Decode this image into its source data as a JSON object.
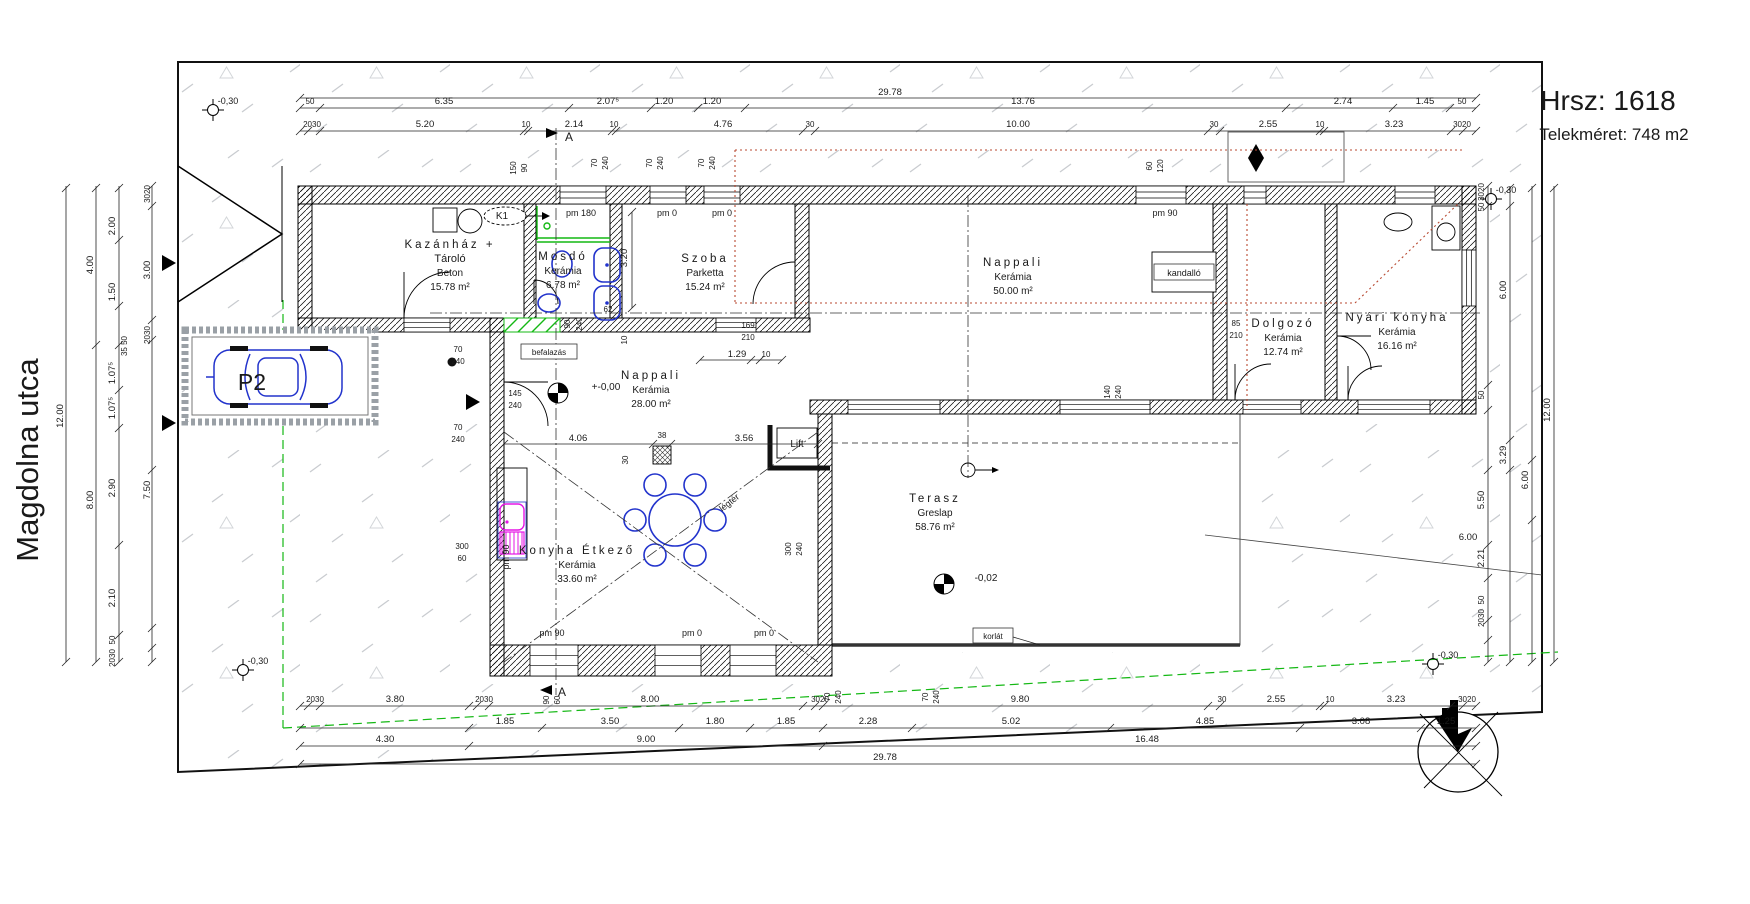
{
  "title": {
    "parcel": "Hrsz: 1618",
    "site_area": "Telekméret: 748 m2"
  },
  "street": {
    "name": "Magdolna utca"
  },
  "parking": {
    "label": "P2"
  },
  "rooms": [
    {
      "id": "kazanhaz",
      "name": "Kazánház +",
      "name2": "Tároló",
      "floor": "Beton",
      "area": "15.78 m²",
      "x": 450,
      "y": 248
    },
    {
      "id": "mosdo",
      "name": "Mosdó",
      "floor": "Kerámia",
      "area": "6.78 m²",
      "x": 563,
      "y": 260
    },
    {
      "id": "szoba",
      "name": "Szoba",
      "floor": "Parketta",
      "area": "15.24 m²",
      "x": 705,
      "y": 262
    },
    {
      "id": "nappali-nagy",
      "name": "Nappali",
      "floor": "Kerámia",
      "area": "50.00 m²",
      "x": 1013,
      "y": 266
    },
    {
      "id": "dolgozo",
      "name": "Dolgozó",
      "floor": "Kerámia",
      "area": "12.74 m²",
      "x": 1283,
      "y": 327
    },
    {
      "id": "nyari-konyha",
      "name": "Nyári konyha",
      "floor": "Kerámia",
      "area": "16.16 m²",
      "x": 1397,
      "y": 321
    },
    {
      "id": "nappali-kozep",
      "name": "Nappali",
      "floor": "Kerámia",
      "area": "28.00 m²",
      "x": 651,
      "y": 379
    },
    {
      "id": "konyha-etkezo",
      "name": "Konyha Étkező",
      "floor": "Kerámia",
      "area": "33.60 m²",
      "x": 577,
      "y": 554
    },
    {
      "id": "terasz",
      "name": "Terasz",
      "floor": "Greslap",
      "area": "58.76 m²",
      "x": 935,
      "y": 502
    }
  ],
  "annotations": [
    {
      "id": "k1",
      "t": "K1",
      "x": 502,
      "y": 219,
      "s": 10
    },
    {
      "id": "kandallo",
      "t": "kandalló",
      "x": 1184,
      "y": 276,
      "box": true,
      "w": 60,
      "s": 9
    },
    {
      "id": "befalazas",
      "t": "befalazás",
      "x": 549,
      "y": 355,
      "box": true,
      "w": 56,
      "s": 8
    },
    {
      "id": "lift",
      "t": "Lift",
      "x": 797,
      "y": 447,
      "s": 10
    },
    {
      "id": "legter",
      "t": "légtér",
      "x": 731,
      "y": 505,
      "r": -38,
      "s": 9
    },
    {
      "id": "korlat",
      "t": "korlát",
      "x": 993,
      "y": 639,
      "box": true,
      "w": 40,
      "s": 8
    }
  ],
  "levels": [
    {
      "t": "+-0,00",
      "x": 606,
      "y": 390,
      "sx": 558,
      "sy": 393
    },
    {
      "t": "-0,02",
      "x": 986,
      "y": 581,
      "sx": 944,
      "sy": 584
    }
  ],
  "survey_points": [
    {
      "t": "-0,30",
      "x": 228,
      "y": 104,
      "sx": 213,
      "sy": 110
    },
    {
      "t": "-0,30",
      "x": 1506,
      "y": 193,
      "sx": 1491,
      "sy": 199
    },
    {
      "t": "-0,30",
      "x": 258,
      "y": 664,
      "sx": 243,
      "sy": 670
    },
    {
      "t": "-0,30",
      "x": 1448,
      "y": 658,
      "sx": 1433,
      "sy": 664
    }
  ],
  "sections": [
    {
      "t": "A",
      "x": 569,
      "y": 141,
      "ax": 546,
      "ay": 133,
      "dir": 1
    },
    {
      "t": "A",
      "x": 562,
      "y": 696,
      "ax": 540,
      "ay": 690,
      "dir": -1
    }
  ],
  "pm_labels": [
    {
      "t": "pm 180",
      "x": 581,
      "y": 216
    },
    {
      "t": "pm 0",
      "x": 667,
      "y": 216
    },
    {
      "t": "pm 0",
      "x": 722,
      "y": 216
    },
    {
      "t": "pm 90",
      "x": 1165,
      "y": 216
    },
    {
      "t": "pm 90",
      "x": 552,
      "y": 636
    },
    {
      "t": "pm 0",
      "x": 692,
      "y": 636
    },
    {
      "t": "pm 0",
      "x": 764,
      "y": 636
    },
    {
      "t": "pm 90",
      "x": 509,
      "y": 557,
      "r": -90
    }
  ],
  "dim_texts": [
    {
      "t": "29.78",
      "x": 890,
      "y": 95
    },
    {
      "t": "50",
      "x": 310,
      "y": 104,
      "s": 8
    },
    {
      "t": "6.35",
      "x": 444,
      "y": 104
    },
    {
      "t": "2.07⁵",
      "x": 608,
      "y": 104
    },
    {
      "t": "1.20",
      "x": 664,
      "y": 104
    },
    {
      "t": "1.20",
      "x": 712,
      "y": 104
    },
    {
      "t": "13.76",
      "x": 1023,
      "y": 104
    },
    {
      "t": "2.74",
      "x": 1343,
      "y": 104
    },
    {
      "t": "1.45",
      "x": 1425,
      "y": 104
    },
    {
      "t": "50",
      "x": 1462,
      "y": 104,
      "s": 8
    },
    {
      "t": "2030",
      "x": 312,
      "y": 127,
      "s": 8
    },
    {
      "t": "5.20",
      "x": 425,
      "y": 127
    },
    {
      "t": "10",
      "x": 526,
      "y": 127,
      "s": 8
    },
    {
      "t": "2.14",
      "x": 574,
      "y": 127
    },
    {
      "t": "10",
      "x": 614,
      "y": 127,
      "s": 8
    },
    {
      "t": "4.76",
      "x": 723,
      "y": 127
    },
    {
      "t": "30",
      "x": 810,
      "y": 127,
      "s": 8
    },
    {
      "t": "10.00",
      "x": 1018,
      "y": 127
    },
    {
      "t": "30",
      "x": 1214,
      "y": 127,
      "s": 8
    },
    {
      "t": "2.55",
      "x": 1268,
      "y": 127
    },
    {
      "t": "10",
      "x": 1320,
      "y": 127,
      "s": 8
    },
    {
      "t": "3.23",
      "x": 1394,
      "y": 127
    },
    {
      "t": "3020",
      "x": 1462,
      "y": 127,
      "s": 8
    },
    {
      "t": "2030",
      "x": 315,
      "y": 702,
      "s": 8
    },
    {
      "t": "3.80",
      "x": 395,
      "y": 702
    },
    {
      "t": "2030",
      "x": 484,
      "y": 702,
      "s": 8
    },
    {
      "t": "8.00",
      "x": 650,
      "y": 702
    },
    {
      "t": "3020",
      "x": 820,
      "y": 702,
      "s": 8
    },
    {
      "t": "9.80",
      "x": 1020,
      "y": 702
    },
    {
      "t": "30",
      "x": 1222,
      "y": 702,
      "s": 8
    },
    {
      "t": "2.55",
      "x": 1276,
      "y": 702
    },
    {
      "t": "10",
      "x": 1330,
      "y": 702,
      "s": 8
    },
    {
      "t": "3.23",
      "x": 1396,
      "y": 702
    },
    {
      "t": "3020",
      "x": 1467,
      "y": 702,
      "s": 8
    },
    {
      "t": "1.85",
      "x": 505,
      "y": 724
    },
    {
      "t": "3.50",
      "x": 610,
      "y": 724
    },
    {
      "t": "1.80",
      "x": 715,
      "y": 724
    },
    {
      "t": "1.85",
      "x": 786,
      "y": 724
    },
    {
      "t": "2.28",
      "x": 868,
      "y": 724
    },
    {
      "t": "5.02",
      "x": 1011,
      "y": 724
    },
    {
      "t": "4.85",
      "x": 1205,
      "y": 724
    },
    {
      "t": "3.08",
      "x": 1361,
      "y": 724
    },
    {
      "t": "1.25",
      "x": 1446,
      "y": 724
    },
    {
      "t": "4.30",
      "x": 385,
      "y": 742
    },
    {
      "t": "9.00",
      "x": 646,
      "y": 742
    },
    {
      "t": "16.48",
      "x": 1147,
      "y": 742
    },
    {
      "t": "29.78",
      "x": 885,
      "y": 760
    },
    {
      "t": "12.00",
      "x": 63,
      "y": 416,
      "r": -90
    },
    {
      "t": "4.00",
      "x": 93,
      "y": 265,
      "r": -90
    },
    {
      "t": "8.00",
      "x": 93,
      "y": 500,
      "r": -90
    },
    {
      "t": "2.00",
      "x": 115,
      "y": 226,
      "r": -90
    },
    {
      "t": "1.50",
      "x": 115,
      "y": 292,
      "r": -90
    },
    {
      "t": "1.07⁵",
      "x": 115,
      "y": 373,
      "r": -90
    },
    {
      "t": "1.07⁵",
      "x": 115,
      "y": 408,
      "r": -90
    },
    {
      "t": "2.90",
      "x": 115,
      "y": 488,
      "r": -90
    },
    {
      "t": "2.10",
      "x": 115,
      "y": 598,
      "r": -90
    },
    {
      "t": "35 50",
      "x": 127,
      "y": 346,
      "r": -90,
      "s": 8
    },
    {
      "t": "3020",
      "x": 150,
      "y": 194,
      "r": -90,
      "s": 8
    },
    {
      "t": "3.00",
      "x": 150,
      "y": 270,
      "r": -90
    },
    {
      "t": "2030",
      "x": 150,
      "y": 335,
      "r": -90,
      "s": 8
    },
    {
      "t": "7.50",
      "x": 150,
      "y": 490,
      "r": -90
    },
    {
      "t": "50",
      "x": 115,
      "y": 640,
      "r": -90,
      "s": 8
    },
    {
      "t": "2030",
      "x": 115,
      "y": 658,
      "r": -90,
      "s": 8
    },
    {
      "t": "3020",
      "x": 1484,
      "y": 192,
      "r": -90,
      "s": 8
    },
    {
      "t": "50",
      "x": 1484,
      "y": 207,
      "r": -90,
      "s": 8
    },
    {
      "t": "50",
      "x": 1484,
      "y": 395,
      "r": -90,
      "s": 8
    },
    {
      "t": "5.50",
      "x": 1484,
      "y": 500,
      "r": -90
    },
    {
      "t": "2.21",
      "x": 1484,
      "y": 558,
      "r": -90
    },
    {
      "t": "50",
      "x": 1484,
      "y": 600,
      "r": -90,
      "s": 8
    },
    {
      "t": "2030",
      "x": 1484,
      "y": 618,
      "r": -90,
      "s": 8
    },
    {
      "t": "6.00",
      "x": 1506,
      "y": 290,
      "r": -90
    },
    {
      "t": "3.29",
      "x": 1506,
      "y": 455,
      "r": -90
    },
    {
      "t": "6.00",
      "x": 1528,
      "y": 480,
      "r": -90
    },
    {
      "t": "12.00",
      "x": 1550,
      "y": 410,
      "r": -90
    },
    {
      "t": "6.00",
      "x": 1468,
      "y": 540
    },
    {
      "t": "4.06",
      "x": 578,
      "y": 441
    },
    {
      "t": "38",
      "x": 662,
      "y": 438,
      "s": 8
    },
    {
      "t": "3.56",
      "x": 744,
      "y": 441
    },
    {
      "t": "30",
      "x": 628,
      "y": 460,
      "r": -90,
      "s": 8
    },
    {
      "t": "1.29",
      "x": 737,
      "y": 357
    },
    {
      "t": "10",
      "x": 766,
      "y": 357,
      "s": 8
    },
    {
      "t": "3.20",
      "x": 627,
      "y": 258,
      "r": -90
    },
    {
      "t": "169",
      "x": 748,
      "y": 328,
      "s": 8
    },
    {
      "t": "210",
      "x": 748,
      "y": 340,
      "s": 8
    },
    {
      "t": "145",
      "x": 515,
      "y": 396,
      "s": 8
    },
    {
      "t": "240",
      "x": 515,
      "y": 408,
      "s": 8
    },
    {
      "t": "70",
      "x": 458,
      "y": 352,
      "s": 8
    },
    {
      "t": "240",
      "x": 458,
      "y": 364,
      "s": 8
    },
    {
      "t": "70",
      "x": 458,
      "y": 430,
      "s": 8
    },
    {
      "t": "240",
      "x": 458,
      "y": 442,
      "s": 8
    },
    {
      "t": "300",
      "x": 462,
      "y": 549,
      "s": 8
    },
    {
      "t": "60",
      "x": 462,
      "y": 561,
      "s": 8
    },
    {
      "t": "90",
      "x": 570,
      "y": 324,
      "r": -90,
      "s": 8
    },
    {
      "t": "240",
      "x": 582,
      "y": 324,
      "r": -90,
      "s": 8
    },
    {
      "t": "62",
      "x": 608,
      "y": 312,
      "s": 8
    },
    {
      "t": "10",
      "x": 627,
      "y": 340,
      "r": -90,
      "s": 8
    },
    {
      "t": "85",
      "x": 1236,
      "y": 326,
      "s": 8
    },
    {
      "t": "210",
      "x": 1236,
      "y": 338,
      "s": 8
    },
    {
      "t": "140",
      "x": 1110,
      "y": 392,
      "r": -90,
      "s": 8
    },
    {
      "t": "240",
      "x": 1121,
      "y": 392,
      "r": -90,
      "s": 8
    },
    {
      "t": "300",
      "x": 791,
      "y": 549,
      "r": -90,
      "s": 8
    },
    {
      "t": "240",
      "x": 802,
      "y": 549,
      "r": -90,
      "s": 8
    },
    {
      "t": "90",
      "x": 549,
      "y": 700,
      "r": -90,
      "s": 8
    },
    {
      "t": "60",
      "x": 560,
      "y": 700,
      "r": -90,
      "s": 8
    },
    {
      "t": "70",
      "x": 830,
      "y": 697,
      "r": -90,
      "s": 8
    },
    {
      "t": "240",
      "x": 841,
      "y": 697,
      "r": -90,
      "s": 8
    },
    {
      "t": "70",
      "x": 928,
      "y": 697,
      "r": -90,
      "s": 8
    },
    {
      "t": "240",
      "x": 939,
      "y": 697,
      "r": -90,
      "s": 8
    },
    {
      "t": "150",
      "x": 516,
      "y": 168,
      "r": -90,
      "s": 8
    },
    {
      "t": "90",
      "x": 527,
      "y": 168,
      "r": -90,
      "s": 8
    },
    {
      "t": "70",
      "x": 597,
      "y": 163,
      "r": -90,
      "s": 8
    },
    {
      "t": "240",
      "x": 608,
      "y": 163,
      "r": -90,
      "s": 8
    },
    {
      "t": "70",
      "x": 652,
      "y": 163,
      "r": -90,
      "s": 8
    },
    {
      "t": "240",
      "x": 663,
      "y": 163,
      "r": -90,
      "s": 8
    },
    {
      "t": "70",
      "x": 704,
      "y": 163,
      "r": -90,
      "s": 8
    },
    {
      "t": "240",
      "x": 715,
      "y": 163,
      "r": -90,
      "s": 8
    },
    {
      "t": "60",
      "x": 1152,
      "y": 166,
      "r": -90,
      "s": 8
    },
    {
      "t": "120",
      "x": 1163,
      "y": 166,
      "r": -90,
      "s": 8
    }
  ],
  "colors": {
    "fixture_blue": "#2233cc",
    "kitchen_magenta": "#e516e5",
    "boundary_green": "#14b814",
    "roof_red": "#b84a32",
    "terrain_gray": "#c9ccd0"
  }
}
